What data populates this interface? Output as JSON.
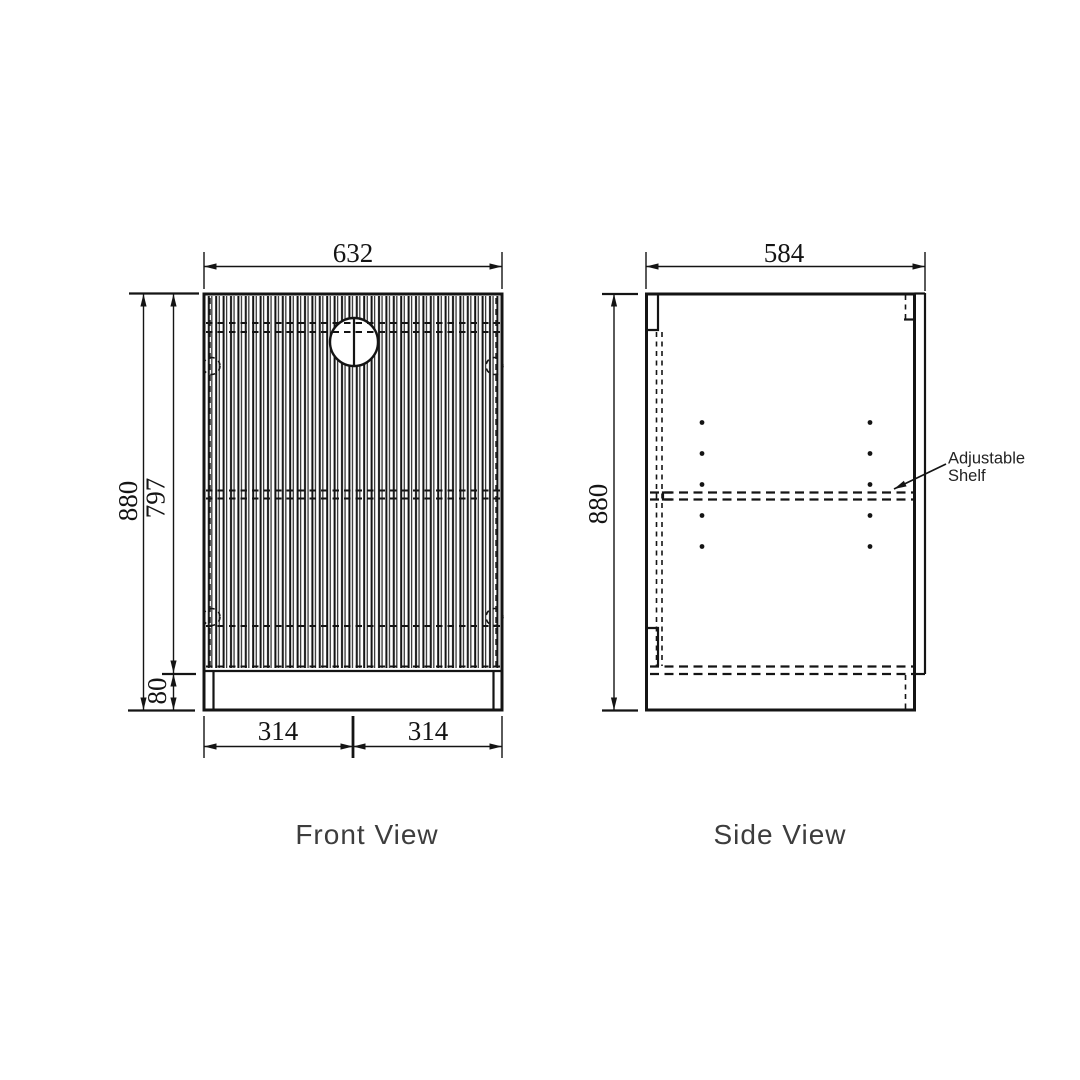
{
  "drawing": {
    "front_view": {
      "label": "Front View",
      "dims": {
        "width": "632",
        "height": "880",
        "door_height": "797",
        "plinth_height": "80",
        "half_width_left": "314",
        "half_width_right": "314"
      }
    },
    "side_view": {
      "label": "Side View",
      "dims": {
        "depth": "584",
        "height": "880"
      },
      "annotation": {
        "line1": "Adjustable",
        "line2": "Shelf"
      }
    },
    "colors": {
      "line": "#141414",
      "dim_text": "#141414",
      "label_text": "#3d3d3d",
      "background": "#ffffff"
    }
  }
}
